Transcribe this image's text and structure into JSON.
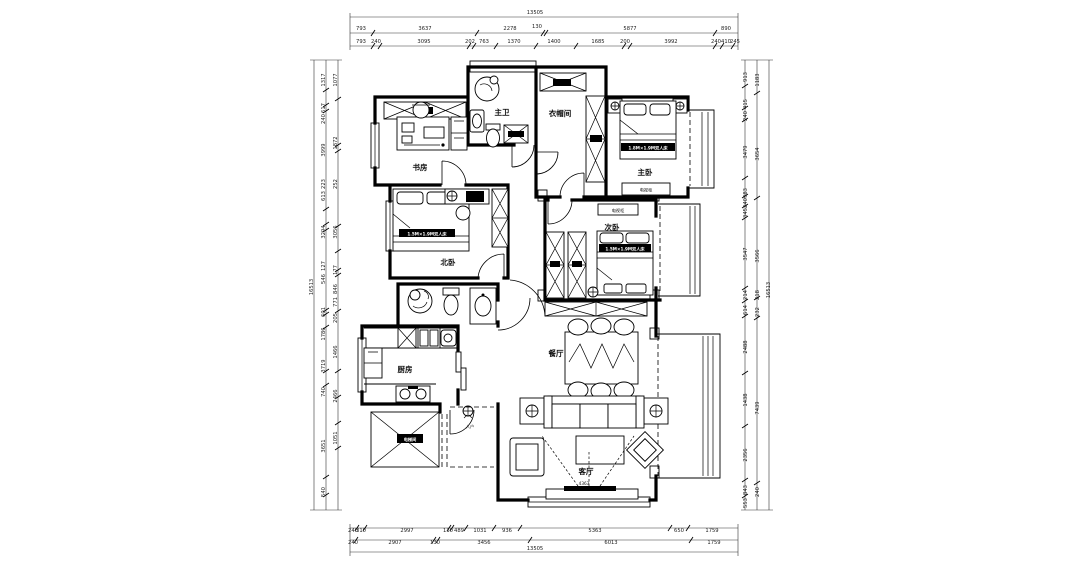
{
  "drawing": {
    "rooms": {
      "study": "书房",
      "master_bath": "主卫",
      "cloakroom": "衣帽间",
      "master_bedroom": "主卧",
      "second_bedroom": "次卧",
      "north_bedroom": "北卧",
      "kitchen": "厨房",
      "dining": "餐厅",
      "living": "客厅",
      "entry": "入户",
      "elevator": "电梯间"
    },
    "furniture": {
      "master_bed": "1.8M×1.9M双人床",
      "north_bed": "1.5M×1.9M双人床",
      "second_bed": "1.5M×1.9M双人床",
      "tv_cabinet_master": "电视柜",
      "tv_cabinet_second": "电视柜",
      "living_width": "4363"
    }
  },
  "dims": {
    "top_total": "13505",
    "top_r2": [
      "793",
      "3637",
      "2278",
      "130",
      "5877",
      "890"
    ],
    "top_r3": [
      "793",
      "240",
      "3095",
      "202",
      "763",
      "1370",
      "1400",
      "1685",
      "200",
      "3992",
      "240",
      "410",
      "245"
    ],
    "bot_r1": [
      "240",
      "310",
      "2997",
      "130",
      "489",
      "1031",
      "936",
      "5363",
      "650",
      "1759"
    ],
    "bot_r2": [
      "240",
      "2907",
      "130",
      "3456",
      "6013",
      "1759"
    ],
    "bot_total": "13505",
    "left_total": "16513",
    "left_col": [
      "1077",
      "1317",
      "617",
      "240",
      "3999",
      "1872",
      "223",
      "252",
      "613",
      "3294",
      "3056",
      "127",
      "546",
      "177",
      "846",
      "771",
      "601",
      "1786",
      "205",
      "3719",
      "1466",
      "740",
      "2466",
      "3651",
      "1051",
      "540"
    ],
    "right_total": "16513",
    "right_col": [
      "913",
      "1183",
      "415",
      "240",
      "3479",
      "3654",
      "983",
      "240",
      "345",
      "3547",
      "3566",
      "214",
      "218",
      "614",
      "232",
      "2488",
      "1438",
      "7439",
      "2356",
      "843",
      "240",
      "553"
    ]
  }
}
